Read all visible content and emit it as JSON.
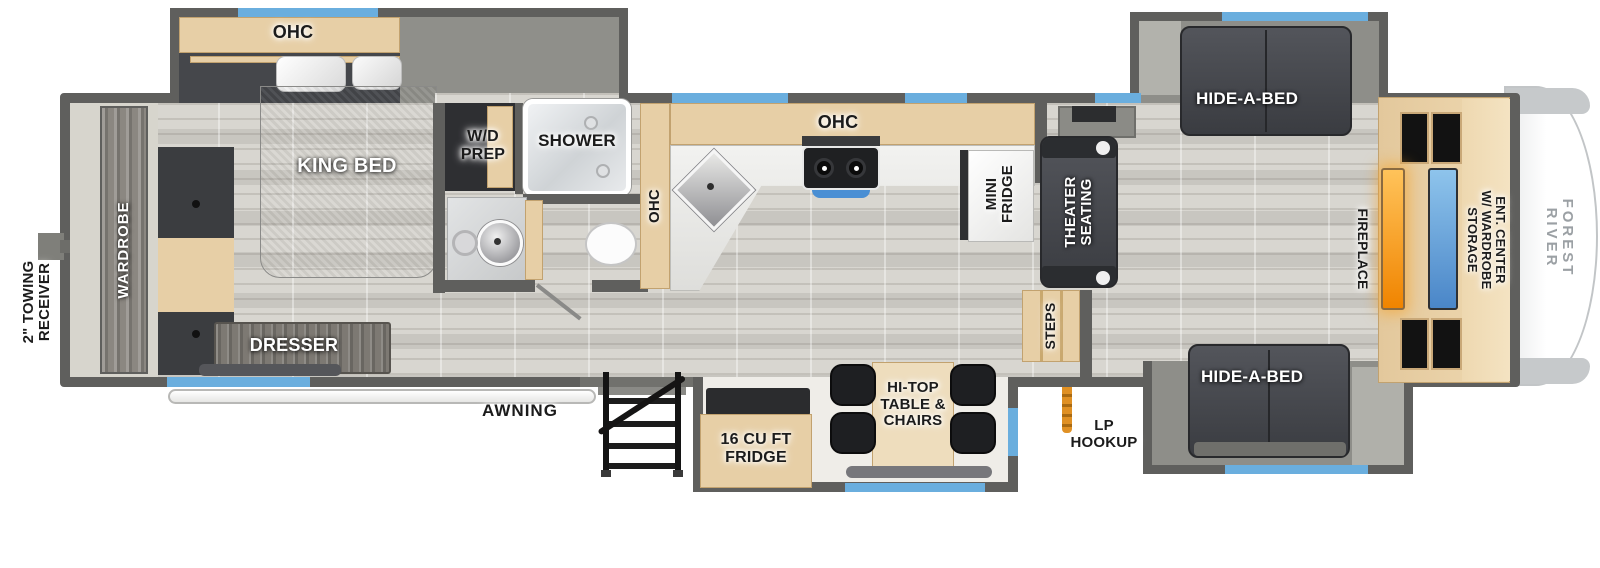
{
  "plan": {
    "brand_label": "FOREST RIVER",
    "exterior": {
      "towing_receiver": "2\" TOWING\nRECEIVER",
      "awning": "AWNING",
      "lp_hookup": "LP\nHOOKUP"
    },
    "bedroom": {
      "ohc": "OHC",
      "king_bed": "KING BED",
      "wardrobe": "WARDROBE",
      "dresser": "DRESSER"
    },
    "bathroom": {
      "wd_prep": "W/D\nPREP",
      "shower": "SHOWER"
    },
    "kitchen": {
      "ohc_pantry": "OHC",
      "ohc_upper": "OHC",
      "mini_fridge": "MINI\nFRIDGE",
      "fridge": "16 CU FT\nFRIDGE",
      "hi_top": "HI-TOP\nTABLE &\nCHAIRS"
    },
    "living": {
      "theater_seating": "THEATER\nSEATING",
      "steps": "STEPS",
      "hide_a_bed_top": "HIDE-A-BED",
      "hide_a_bed_bottom": "HIDE-A-BED",
      "fireplace": "FIREPLACE",
      "ent_center": "ENT. CENTER\nW/ WARDROBE STORAGE"
    },
    "colors": {
      "wall": "#5f5f5d",
      "window_blue": "#6aaede",
      "wood_tan": "#e7cfa6",
      "fireplace_orange": "#f49420",
      "tv_blue": "#5b9bd8",
      "lp_orange": "#dd8a1f"
    }
  }
}
